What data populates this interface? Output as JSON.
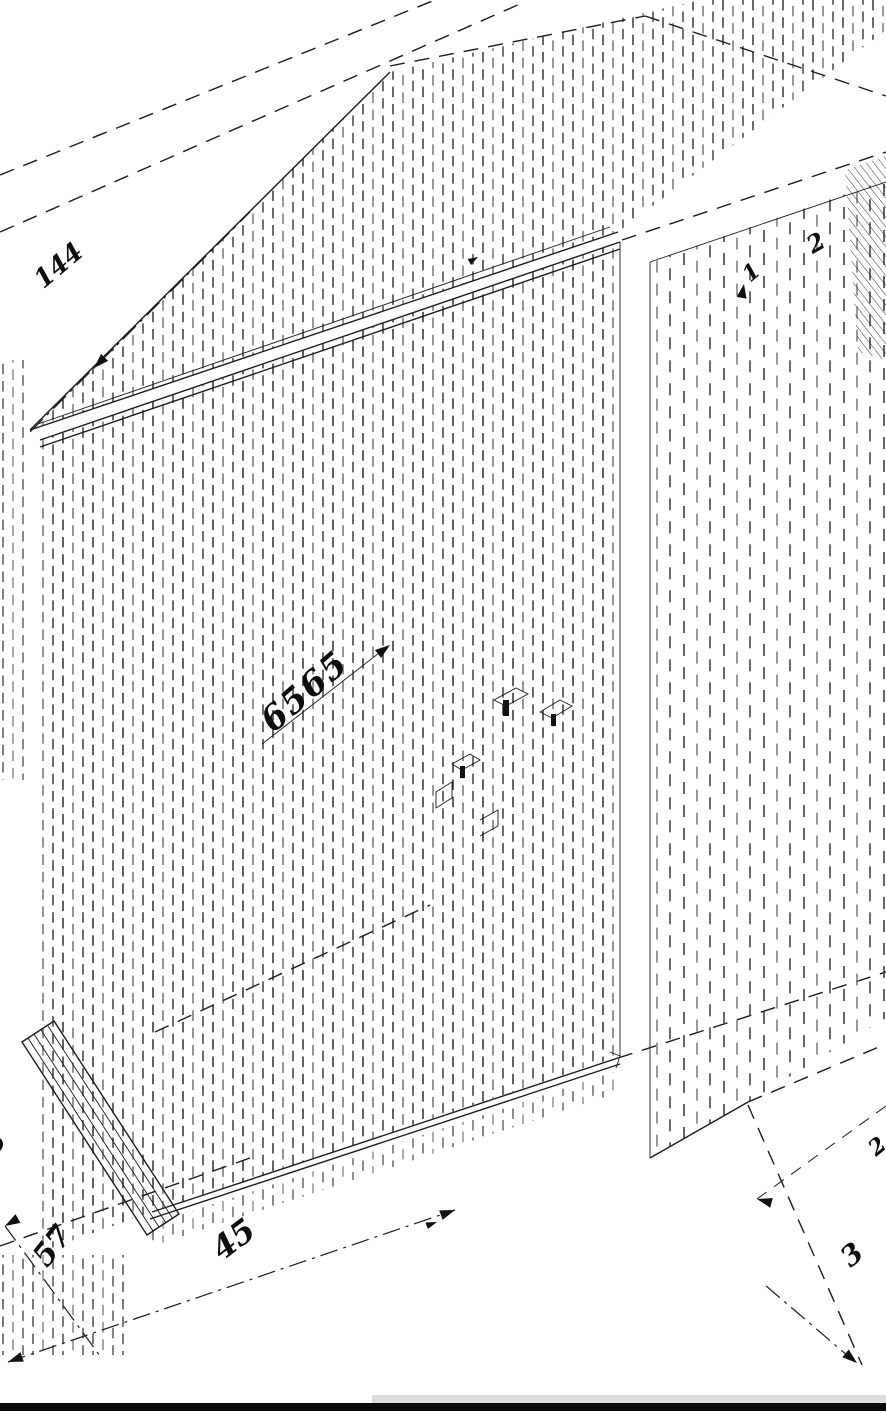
{
  "drawing": {
    "annotations": {
      "dim_top_left": "144",
      "leader_center": "6565",
      "dim_bottom": "45",
      "dim_plinth": "57",
      "label_1": "1",
      "label_2": "2",
      "label_3": "3",
      "label_edge_right": "2",
      "label_edge_left": "5"
    },
    "colors": {
      "line": "#1c1c1c",
      "hatch_dark": "#2e2e2e",
      "hatch_mid": "#6f6f6f",
      "scrollbar": "#dcdcdc",
      "bottom_bar": "#0a0a0a",
      "background": "#ffffff"
    }
  }
}
